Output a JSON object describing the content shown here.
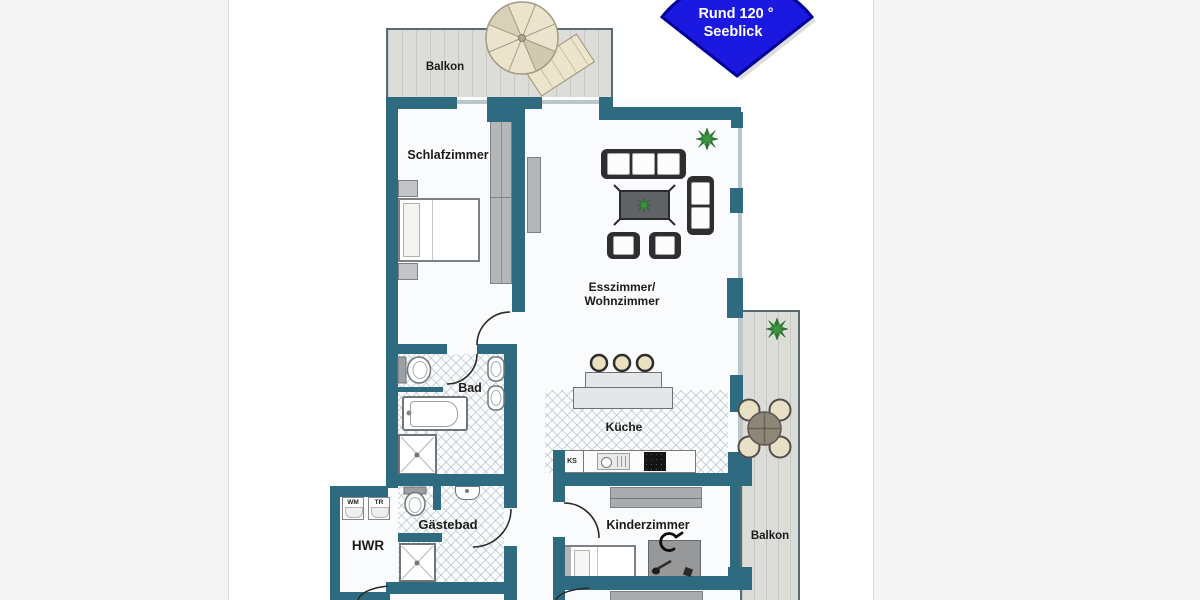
{
  "plan": {
    "badge": {
      "line1": "Rund 120 °",
      "line2": "Seeblick",
      "fill": "#1b19df",
      "border_color": "#000099",
      "text_color": "#ffffff"
    },
    "rooms": {
      "balkon_top": "Balkon",
      "schlafzimmer": "Schlafzimmer",
      "wohnzimmer_line1": "Esszimmer/",
      "wohnzimmer_line2": "Wohnzimmer",
      "bad": "Bad",
      "kueche": "Küche",
      "gaestebad": "Gästebad",
      "hwr": "HWR",
      "kinderzimmer": "Kinderzimmer",
      "balkon_right": "Balkon"
    },
    "appliances": {
      "wm": "WM",
      "tr": "TR",
      "ks": "KS"
    },
    "colors": {
      "wall": "#2f6b80",
      "deck": "#dcdcd8",
      "floor": "#f9fbfc",
      "hatch_line": "#acb8c1",
      "furniture_gray": "#b4b6b7",
      "sofa_dark": "#2e2e30"
    }
  }
}
